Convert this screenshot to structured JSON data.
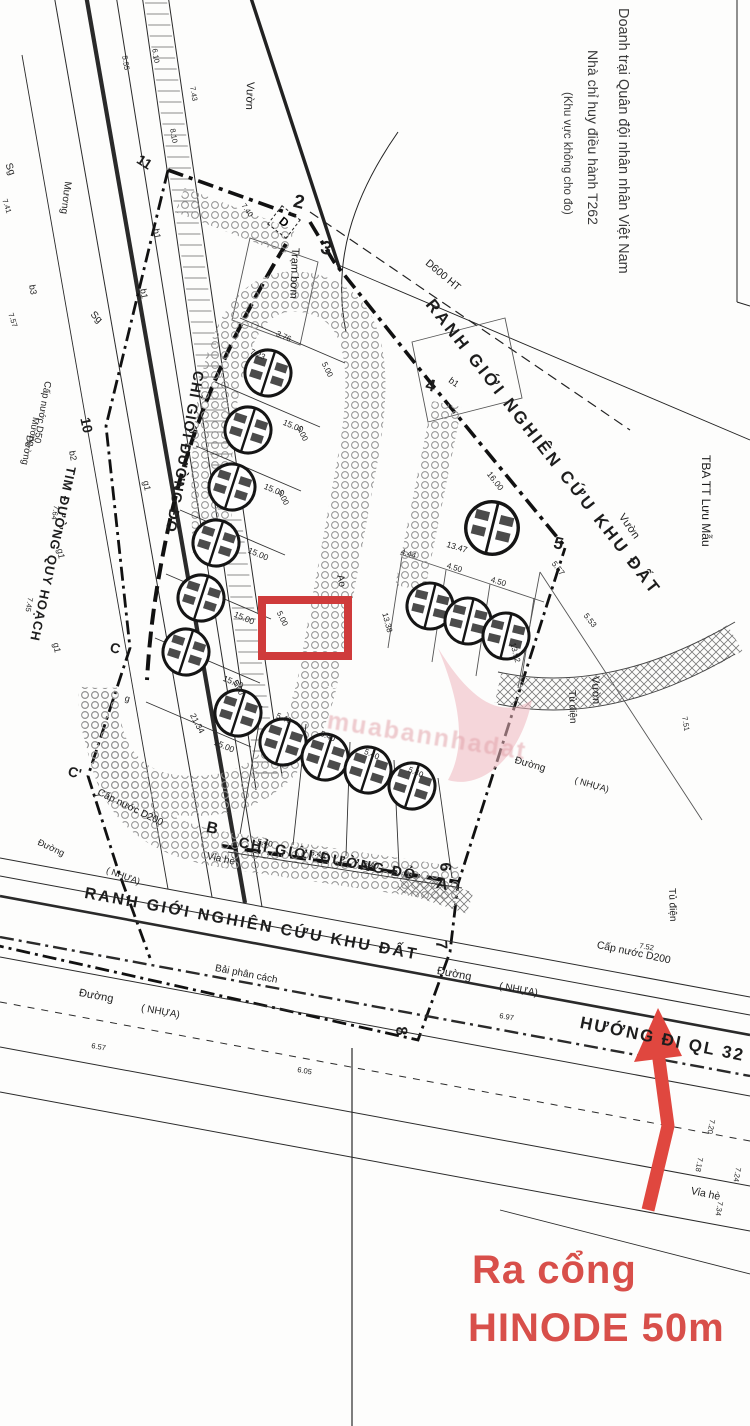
{
  "annotations": {
    "military_line1": "Doanh trại Quân đội nhân nhân Việt Nam",
    "military_line2": "Nhà chỉ huy điều hành T262",
    "military_line3": "(Khu vực không cho đo)",
    "exit_line1": "Ra cổng",
    "exit_line2": "HINODE 50m",
    "direction": "HƯỚNG ĐI QL 32"
  },
  "boundaries": {
    "ranh_gioi": "RANH GIỚI NGHIÊN CỨU KHU ĐẤT",
    "chi_gioi": "CHỈ GIỚI ĐƯỜNG ĐỎ",
    "tim_duong": "TIM ĐƯỜNG QUY HOẠCH"
  },
  "points": {
    "p2": "2",
    "p3": "3",
    "p4": "4",
    "p5": "5",
    "p6": "6",
    "p7": "7",
    "p8": "8",
    "p10": "10",
    "p11": "11",
    "pA": "A",
    "pB": "B",
    "pC": "C",
    "pC2": "C'",
    "pD": "D"
  },
  "features": {
    "vuon": "Vườn",
    "tram_bom": "Trạm bơm",
    "muong": "Mương",
    "sg": "Sg",
    "ao": "Ao",
    "tu_dien": "Tủ điện",
    "tba": "TBA TT Lưu Mẫu",
    "d600": "D600 HT",
    "via_he": "Vỉa hè",
    "duong": "Đường",
    "nhua": "( NHỰA)",
    "cap_nuoc_d200": "Cấp nước D200",
    "cap_nuoc_d50": "Cấp nước D50",
    "bai_phan_cach": "Bải phân cách",
    "b1": "b1",
    "b2": "b2",
    "b3": "b3",
    "g1": "g1",
    "g": "g",
    "one": "1"
  },
  "dims": {
    "d15": "15.00",
    "d5": "5.00",
    "d54": "5.40",
    "d1347": "13.47",
    "d444": "4.44",
    "d450": "4.50",
    "d2134": "21.34",
    "d16": "16.00",
    "d557": "5.57",
    "d553": "5.53",
    "d1338": "13.38",
    "d1392": "13.92",
    "d376": "3.76",
    "d723": "7.23"
  },
  "spots": {
    "s1": "7.43",
    "s2": "5.55",
    "s3": "6.10",
    "s4": "8.10",
    "s5": "7.41",
    "s6": "7.57",
    "s7": "7.64",
    "s8": "7.45",
    "s9": "7.40",
    "s10": "6.57",
    "s11": "6.05",
    "s12": "6.97",
    "s13": "7.20",
    "s14": "7.18",
    "s15": "7.24",
    "s16": "7.34",
    "s17": "7.52",
    "s18": "7.51"
  },
  "watermark": {
    "text": "muabannhadat"
  },
  "colors": {
    "red_annotation": "#d84f4a",
    "red_box": "#cf3b3b",
    "ink": "#1d1d1d"
  }
}
